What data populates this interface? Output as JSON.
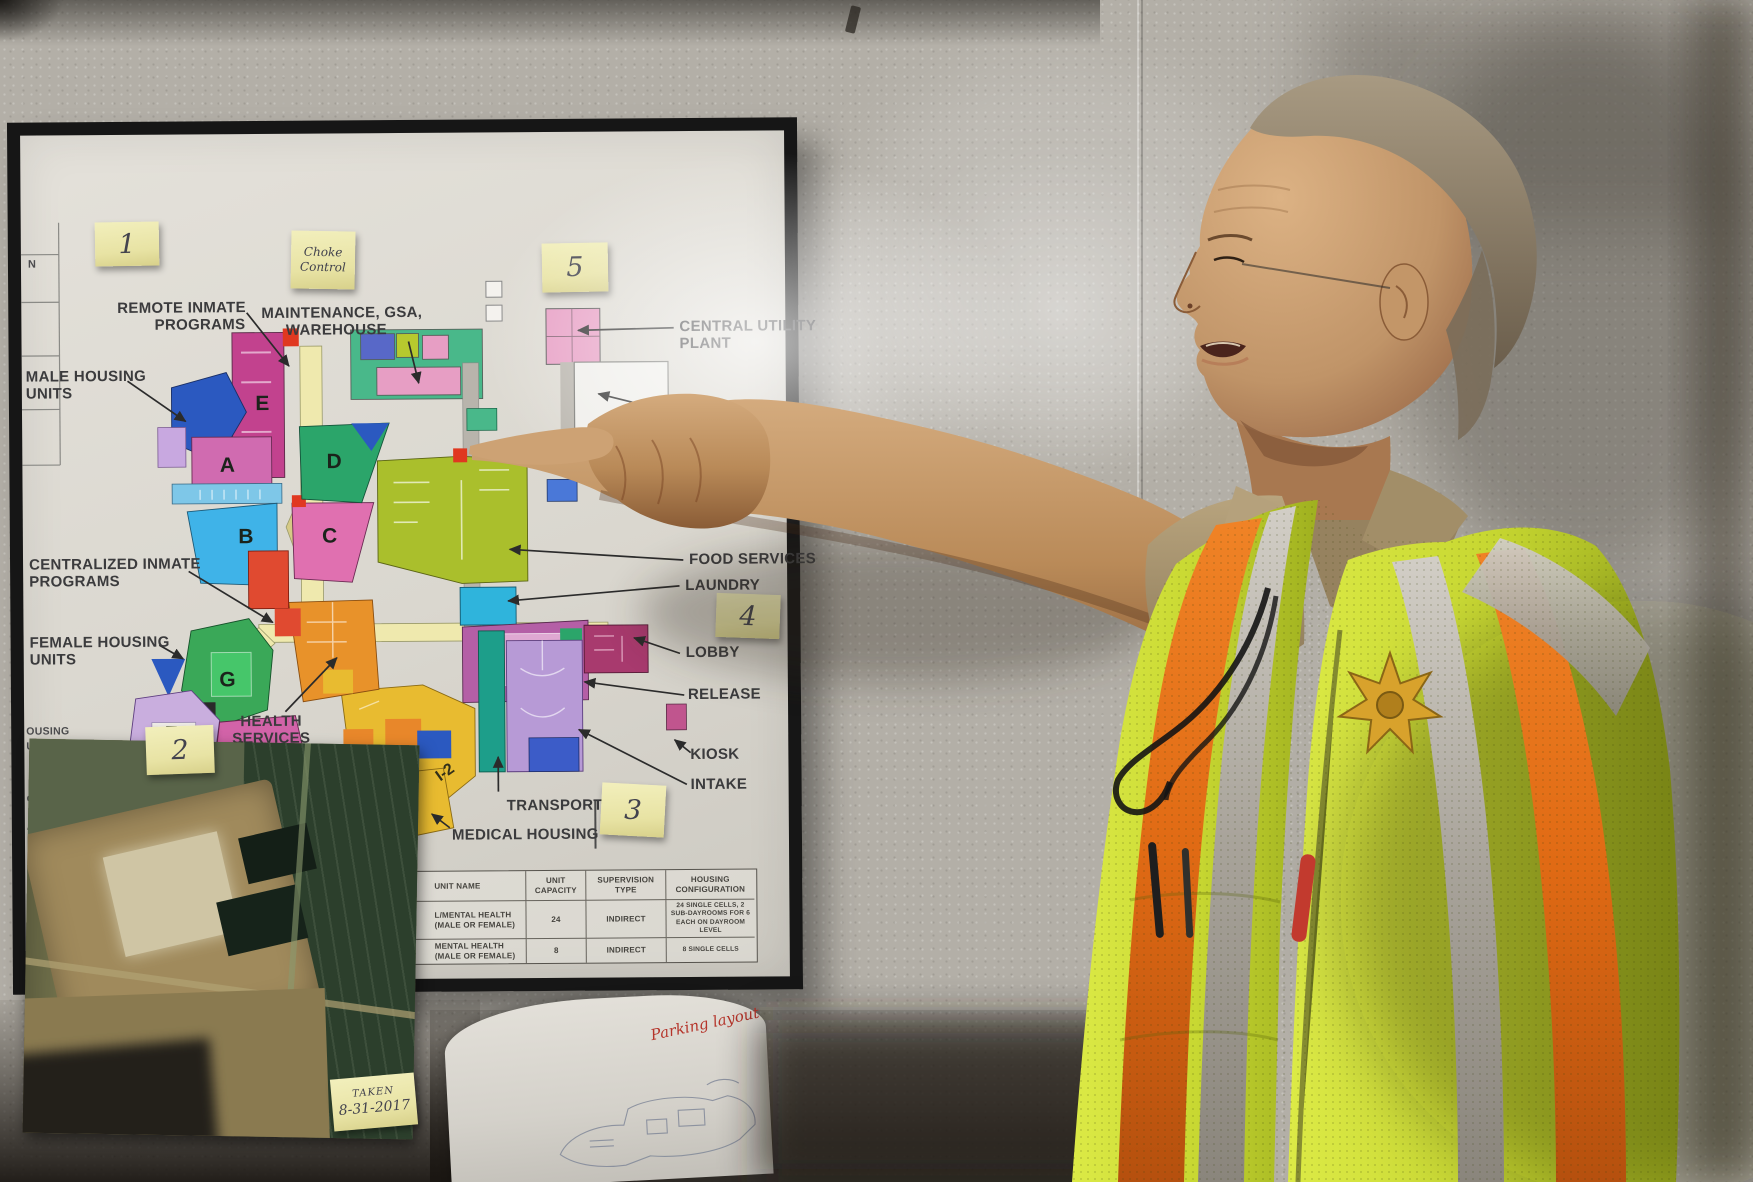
{
  "stickies": {
    "one": "1",
    "two": "2",
    "three": "3",
    "four": "4",
    "five": "5",
    "control": {
      "line1": "Choke",
      "line2": "Control"
    },
    "photo_date": {
      "line1": "TAKEN",
      "line2": "8-31-2017"
    }
  },
  "map": {
    "labels": {
      "remote_1": "REMOTE INMATE",
      "remote_2": "PROGRAMS",
      "maintenance_1": "MAINTENANCE, GSA,",
      "maintenance_2": "WAREHOUSE",
      "male_1": "MALE HOUSING",
      "male_2": "UNITS",
      "central_utility_1": "CENTRAL UTILITY",
      "central_utility_2": "PLANT",
      "service_yard": "SERVICE YARD",
      "centralized_1": "CENTRALIZED INMATE",
      "centralized_2": "PROGRAMS",
      "female_1": "FEMALE HOUSING",
      "female_2": "UNITS",
      "food_services": "FOOD SERVICES",
      "laundry": "LAUNDRY",
      "lobby": "LOBBY",
      "release": "RELEASE",
      "kiosk": "KIOSK",
      "intake": "INTAKE",
      "transport": "TRANSPORT",
      "medical_housing": "MEDICAL HOUSING",
      "health_1": "HEALTH",
      "health_2": "SERVICES",
      "partial_right": "VICES"
    },
    "letters": {
      "a": "A",
      "b": "B",
      "c": "C",
      "d": "D",
      "e": "E",
      "f": "F",
      "g": "G",
      "h": "H",
      "i1": "I-1",
      "i2": "I-2"
    },
    "left_edge": [
      "N",
      "OUSING",
      "URATION",
      "CY CELL",
      "ATE MU",
      "NCY CO"
    ]
  },
  "table": {
    "headers": {
      "name": "UNIT NAME",
      "capacity_1": "UNIT",
      "capacity_2": "CAPACITY",
      "supervision_1": "SUPERVISION",
      "supervision_2": "TYPE",
      "config_1": "HOUSING",
      "config_2": "CONFIGURATION"
    },
    "rows": [
      {
        "name": "L/MENTAL HEALTH (MALE OR FEMALE)",
        "capacity": "24",
        "supervision": "INDIRECT",
        "config": "24 SINGLE CELLS, 2 SUB-DAYROOMS FOR 6 EACH ON DAYROOM LEVEL"
      },
      {
        "name": "MENTAL HEALTH (MALE OR FEMALE)",
        "capacity": "8",
        "supervision": "INDIRECT",
        "config": "8 SINGLE CELLS"
      }
    ]
  },
  "paper": {
    "red_note": "Parking layout"
  },
  "colors": {
    "wall": "#b3afa7",
    "vest_yellow": "#cfe03a",
    "vest_orange": "#ef7d1e",
    "sticky_yellow": "#ece7a8",
    "frame": "#161616"
  }
}
